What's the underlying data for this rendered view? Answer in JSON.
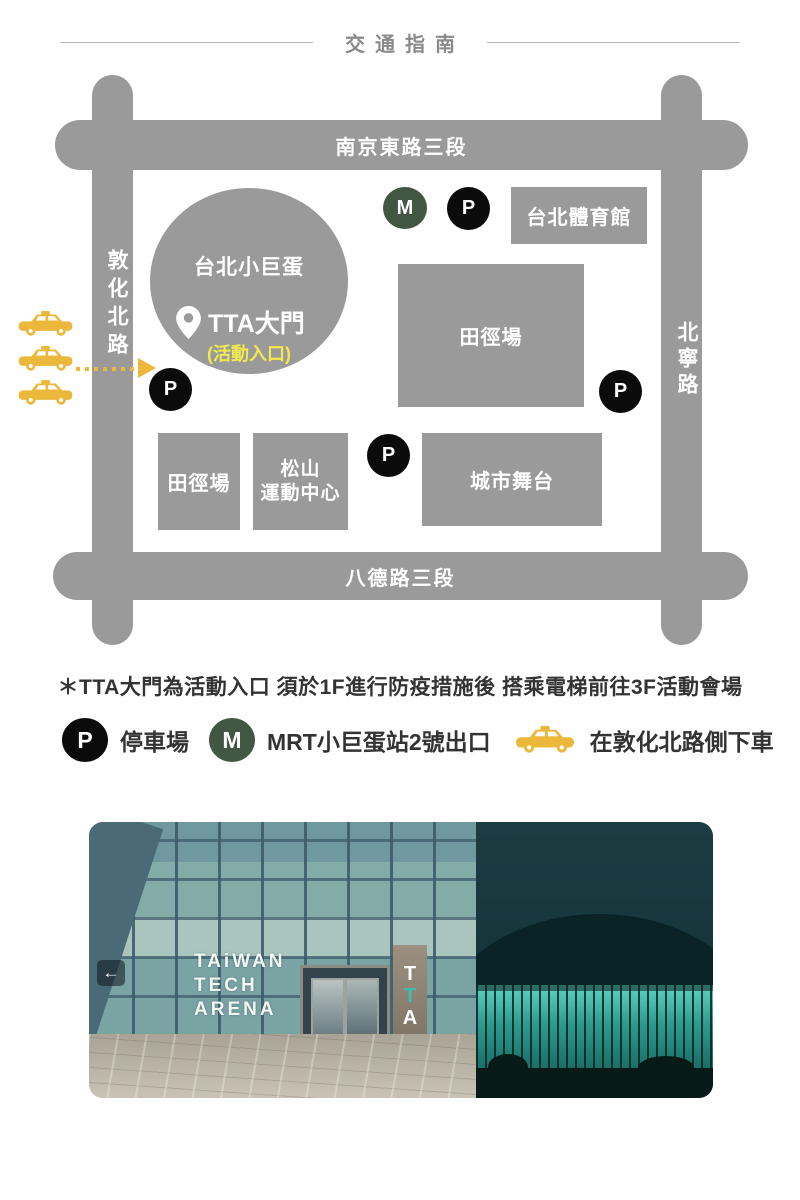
{
  "title": "交通指南",
  "map": {
    "roads": {
      "top": "南京東路三段",
      "bottom": "八德路三段",
      "left": "敦化北路",
      "right": "北寧路"
    },
    "arena": {
      "name": "台北小巨蛋",
      "gate": "TTA大門",
      "gate_sub": "(活動入口)"
    },
    "buildings": [
      {
        "label": "台北體育館"
      },
      {
        "label": "田徑場"
      },
      {
        "label": "田徑場"
      },
      {
        "line1": "松山",
        "line2": "運動中心"
      },
      {
        "label": "城市舞台"
      }
    ],
    "badges": {
      "metro": "M",
      "parking": "P"
    }
  },
  "note": "＊TTA大門為活動入口 須於1F進行防疫措施後 搭乘電梯前往3F活動會場",
  "legend": {
    "parking_symbol": "P",
    "parking_label": "停車場",
    "metro_symbol": "M",
    "metro_label": "MRT小巨蛋站2號出口",
    "taxi_label": "在敦化北路側下車"
  },
  "photos": {
    "left_sign_line1": "TAiWAN",
    "left_sign_line2": "TECH",
    "left_sign_line3": "ARENA",
    "pillar": [
      "T",
      "T",
      "A"
    ],
    "back_arrow": "←"
  },
  "colors": {
    "road_gray": "#9a9a9a",
    "building_gray": "#9a9a9a",
    "metro_green": "#415742",
    "parking_black": "#0b0b0b",
    "taxi_yellow": "#ecb83b",
    "entrance_yellow": "#f1e94d",
    "title_gray": "#8a8a8a",
    "text_dark": "#333333"
  }
}
